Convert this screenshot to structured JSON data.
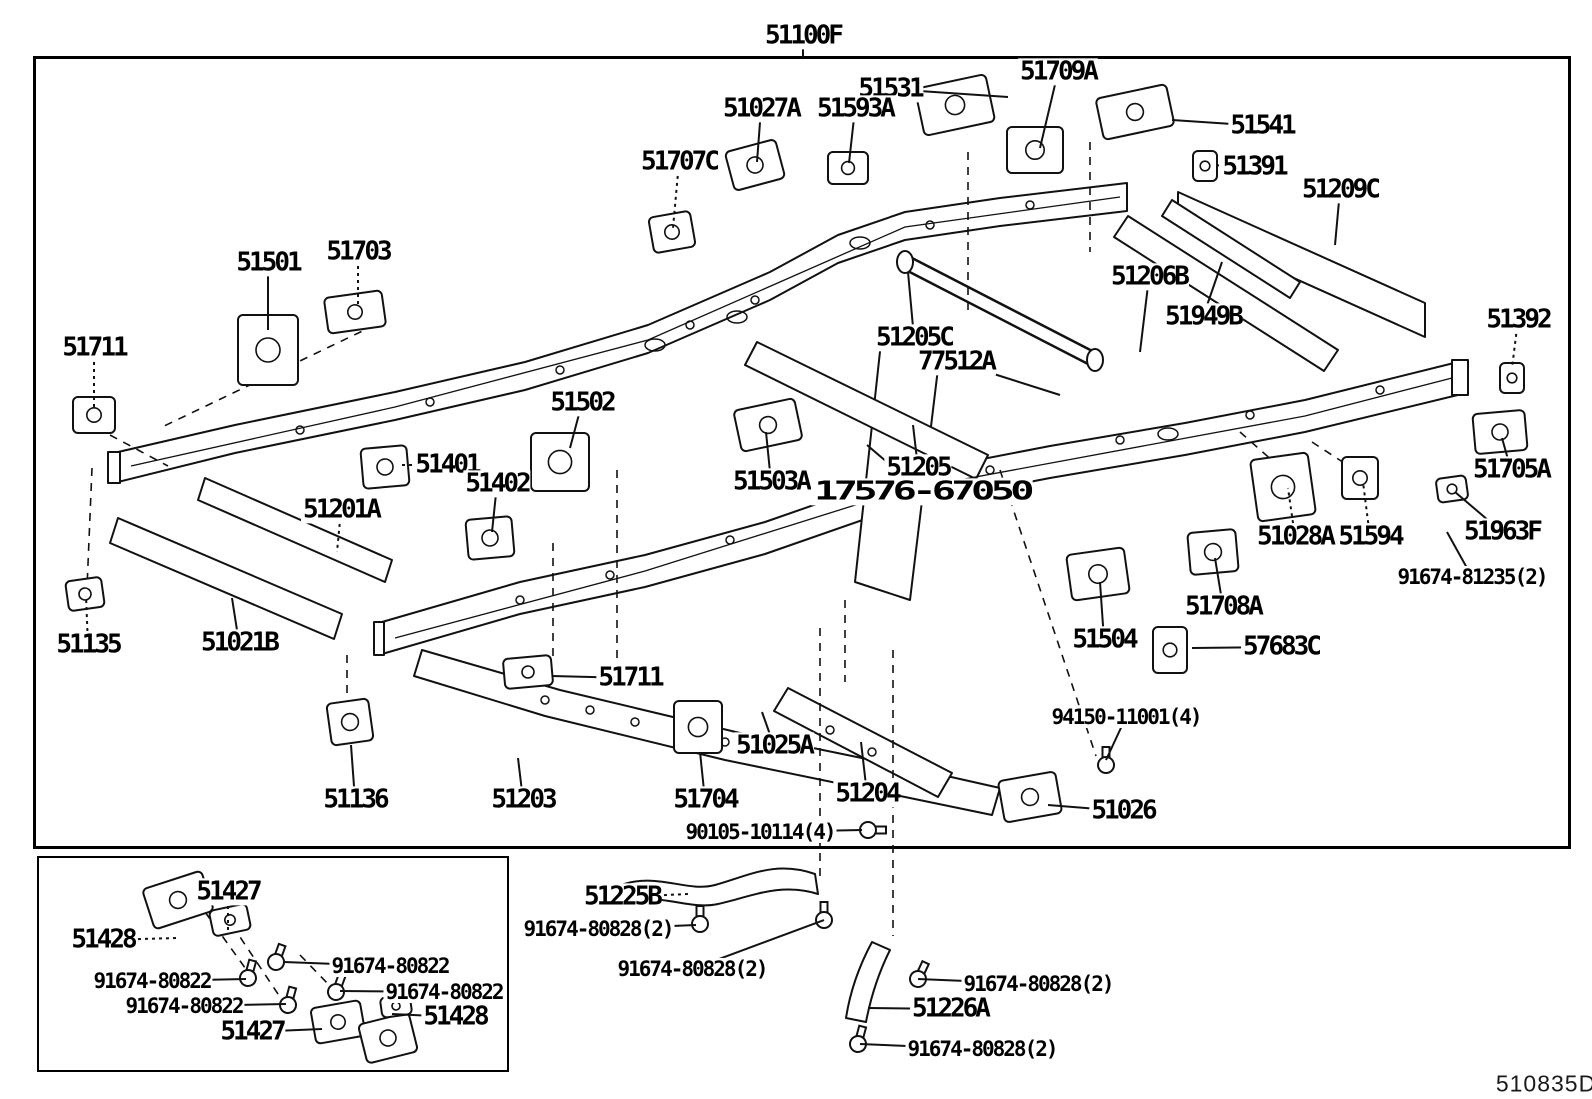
{
  "header": {
    "title_code": "51100F"
  },
  "footer": {
    "corner_code": "510835D"
  },
  "labels": [
    {
      "text": "51531",
      "x": 890,
      "y": 89,
      "cls": "lg",
      "tx": 1008,
      "ty": 97,
      "dashed": false
    },
    {
      "text": "51709A",
      "x": 1058,
      "y": 72,
      "cls": "lg",
      "tx": 1040,
      "ty": 148,
      "dashed": false
    },
    {
      "text": "51027A",
      "x": 761,
      "y": 109,
      "cls": "lg",
      "tx": 757,
      "ty": 162,
      "dashed": false
    },
    {
      "text": "51593A",
      "x": 855,
      "y": 109,
      "cls": "lg",
      "tx": 849,
      "ty": 163,
      "dashed": false
    },
    {
      "text": "51707C",
      "x": 679,
      "y": 162,
      "cls": "lg",
      "tx": 673,
      "ty": 228,
      "dashed": true
    },
    {
      "text": "51541",
      "x": 1262,
      "y": 126,
      "cls": "lg",
      "tx": 1172,
      "ty": 120,
      "dashed": false
    },
    {
      "text": "51391",
      "x": 1254,
      "y": 167,
      "cls": "lg",
      "tx": 1212,
      "ty": 165,
      "dashed": true
    },
    {
      "text": "51209C",
      "x": 1340,
      "y": 190,
      "cls": "lg",
      "tx": 1335,
      "ty": 245,
      "dashed": false
    },
    {
      "text": "51501",
      "x": 268,
      "y": 263,
      "cls": "lg",
      "tx": 268,
      "ty": 330,
      "dashed": false
    },
    {
      "text": "51703",
      "x": 358,
      "y": 252,
      "cls": "lg",
      "tx": 358,
      "ty": 305,
      "dashed": true
    },
    {
      "text": "51711",
      "x": 94,
      "y": 348,
      "cls": "lg",
      "tx": 94,
      "ty": 408,
      "dashed": true
    },
    {
      "text": "51206B",
      "x": 1149,
      "y": 277,
      "cls": "lg",
      "tx": 1140,
      "ty": 352,
      "dashed": false
    },
    {
      "text": "51949B",
      "x": 1203,
      "y": 317,
      "cls": "lg",
      "tx": 1222,
      "ty": 262,
      "dashed": false
    },
    {
      "text": "51205C",
      "x": 914,
      "y": 338,
      "cls": "lg",
      "tx": 908,
      "ty": 272,
      "dashed": false
    },
    {
      "text": "77512A",
      "x": 956,
      "y": 362,
      "cls": "lg",
      "tx": 1060,
      "ty": 395,
      "dashed": false
    },
    {
      "text": "51392",
      "x": 1518,
      "y": 320,
      "cls": "lg",
      "tx": 1512,
      "ty": 368,
      "dashed": true
    },
    {
      "text": "51502",
      "x": 582,
      "y": 403,
      "cls": "lg",
      "tx": 570,
      "ty": 448,
      "dashed": false
    },
    {
      "text": "51401",
      "x": 447,
      "y": 465,
      "cls": "lg",
      "tx": 398,
      "ty": 465,
      "dashed": true
    },
    {
      "text": "51402",
      "x": 497,
      "y": 484,
      "cls": "lg",
      "tx": 492,
      "ty": 532,
      "dashed": false
    },
    {
      "text": "51201A",
      "x": 341,
      "y": 510,
      "cls": "lg",
      "tx": 337,
      "ty": 552,
      "dashed": true
    },
    {
      "text": "51503A",
      "x": 771,
      "y": 482,
      "cls": "lg",
      "tx": 766,
      "ty": 432,
      "dashed": false
    },
    {
      "text": "51205",
      "x": 918,
      "y": 468,
      "cls": "lg",
      "tx": 913,
      "ty": 425,
      "dashed": false
    },
    {
      "text": "17576-67050",
      "x": 922,
      "y": 492,
      "cls": "wide",
      "tx": 867,
      "ty": 445,
      "dashed": false
    },
    {
      "text": "51705A",
      "x": 1511,
      "y": 470,
      "cls": "lg",
      "tx": 1502,
      "ty": 438,
      "dashed": false
    },
    {
      "text": "51028A",
      "x": 1295,
      "y": 537,
      "cls": "lg",
      "tx": 1288,
      "ty": 488,
      "dashed": true
    },
    {
      "text": "51594",
      "x": 1370,
      "y": 537,
      "cls": "lg",
      "tx": 1363,
      "ty": 482,
      "dashed": true
    },
    {
      "text": "51963F",
      "x": 1502,
      "y": 532,
      "cls": "lg",
      "tx": 1455,
      "ty": 492,
      "dashed": false
    },
    {
      "text": "91674-81235(2)",
      "x": 1472,
      "y": 577,
      "cls": "sm",
      "tx": 1447,
      "ty": 532,
      "dashed": false
    },
    {
      "text": "51135",
      "x": 88,
      "y": 645,
      "cls": "lg",
      "tx": 86,
      "ty": 596,
      "dashed": true
    },
    {
      "text": "51021B",
      "x": 239,
      "y": 643,
      "cls": "lg",
      "tx": 232,
      "ty": 598,
      "dashed": false
    },
    {
      "text": "51708A",
      "x": 1223,
      "y": 607,
      "cls": "lg",
      "tx": 1215,
      "ty": 558,
      "dashed": false
    },
    {
      "text": "51504",
      "x": 1104,
      "y": 640,
      "cls": "lg",
      "tx": 1100,
      "ty": 582,
      "dashed": false
    },
    {
      "text": "57683C",
      "x": 1281,
      "y": 647,
      "cls": "lg",
      "tx": 1192,
      "ty": 648,
      "dashed": false
    },
    {
      "text": "51711",
      "x": 630,
      "y": 678,
      "cls": "lg",
      "tx": 552,
      "ty": 676,
      "dashed": false
    },
    {
      "text": "51136",
      "x": 355,
      "y": 800,
      "cls": "lg",
      "tx": 351,
      "ty": 745,
      "dashed": false
    },
    {
      "text": "51203",
      "x": 523,
      "y": 800,
      "cls": "lg",
      "tx": 518,
      "ty": 758,
      "dashed": false
    },
    {
      "text": "51704",
      "x": 705,
      "y": 800,
      "cls": "lg",
      "tx": 700,
      "ty": 752,
      "dashed": false
    },
    {
      "text": "51025A",
      "x": 774,
      "y": 746,
      "cls": "lg",
      "tx": 762,
      "ty": 712,
      "dashed": false
    },
    {
      "text": "51204",
      "x": 867,
      "y": 794,
      "cls": "lg",
      "tx": 861,
      "ty": 742,
      "dashed": false
    },
    {
      "text": "51026",
      "x": 1123,
      "y": 811,
      "cls": "lg",
      "tx": 1048,
      "ty": 805,
      "dashed": false
    },
    {
      "text": "94150-11001(4)",
      "x": 1126,
      "y": 717,
      "cls": "sm",
      "tx": 1106,
      "ty": 760,
      "dashed": false
    },
    {
      "text": "90105-10114(4)",
      "x": 760,
      "y": 832,
      "cls": "sm",
      "tx": 862,
      "ty": 830,
      "dashed": false
    },
    {
      "text": "51225B",
      "x": 622,
      "y": 897,
      "cls": "lg",
      "tx": 688,
      "ty": 894,
      "dashed": true
    },
    {
      "text": "91674-80828(2)",
      "x": 598,
      "y": 929,
      "cls": "sm",
      "tx": 696,
      "ty": 925,
      "dashed": false
    },
    {
      "text": "91674-80828(2)",
      "x": 692,
      "y": 969,
      "cls": "sm",
      "tx": 824,
      "ty": 920,
      "dashed": false
    },
    {
      "text": "91674-80828(2)",
      "x": 1038,
      "y": 984,
      "cls": "sm",
      "tx": 918,
      "ty": 979,
      "dashed": false
    },
    {
      "text": "51226A",
      "x": 950,
      "y": 1009,
      "cls": "lg",
      "tx": 868,
      "ty": 1008,
      "dashed": false
    },
    {
      "text": "91674-80828(2)",
      "x": 982,
      "y": 1049,
      "cls": "sm",
      "tx": 860,
      "ty": 1044,
      "dashed": false
    },
    {
      "text": "51427",
      "x": 228,
      "y": 892,
      "cls": "lg",
      "tx": 228,
      "ty": 930,
      "dashed": true
    },
    {
      "text": "51428",
      "x": 103,
      "y": 940,
      "cls": "lg",
      "tx": 178,
      "ty": 938,
      "dashed": true
    },
    {
      "text": "91674-80822",
      "x": 390,
      "y": 966,
      "cls": "sm",
      "tx": 284,
      "ty": 962,
      "dashed": false
    },
    {
      "text": "91674-80822",
      "x": 152,
      "y": 981,
      "cls": "sm",
      "tx": 246,
      "ty": 979,
      "dashed": false
    },
    {
      "text": "91674-80822",
      "x": 184,
      "y": 1006,
      "cls": "sm",
      "tx": 286,
      "ty": 1004,
      "dashed": false
    },
    {
      "text": "91674-80822",
      "x": 444,
      "y": 992,
      "cls": "sm",
      "tx": 340,
      "ty": 991,
      "dashed": false
    },
    {
      "text": "51428",
      "x": 455,
      "y": 1017,
      "cls": "lg",
      "tx": 392,
      "ty": 1014,
      "dashed": false
    },
    {
      "text": "51427",
      "x": 252,
      "y": 1032,
      "cls": "lg",
      "tx": 322,
      "ty": 1029,
      "dashed": false
    }
  ]
}
